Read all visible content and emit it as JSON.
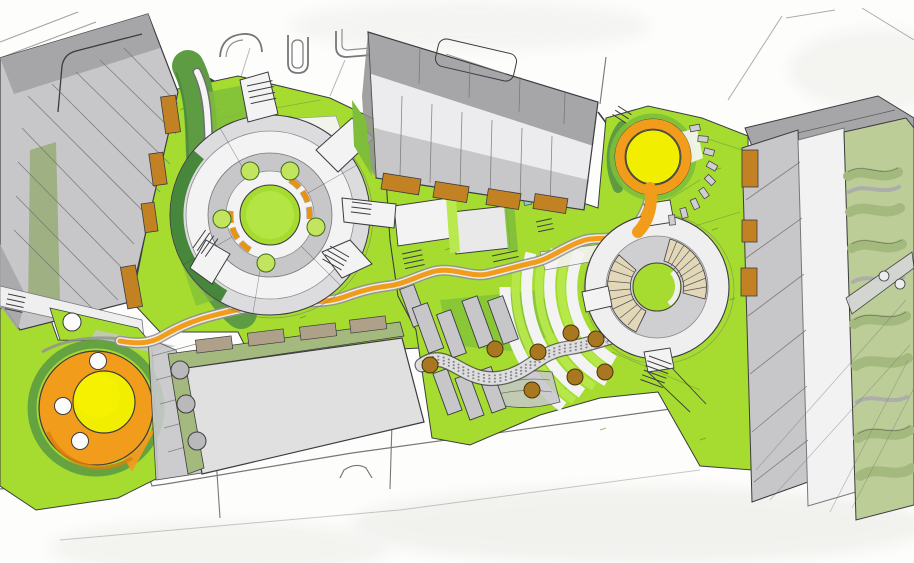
{
  "meta": {
    "kind": "hand-drawn landscape architecture masterplan sketch",
    "canvas_width": 914,
    "canvas_height": 563,
    "visible_text": "none"
  },
  "palette": {
    "paper": "#FDFDFB",
    "paper_wash": "#EDEDEA",
    "lawn": "#A5DC2F",
    "lawn_bright": "#B9E94E",
    "lawn_mid": "#7FBE3A",
    "green_dark": "#5E9C44",
    "green_deep": "#47873B",
    "sage": "#9FB183",
    "sage_band": "#A4B97E",
    "sage_light": "#BCCD97",
    "orange": "#F29C1C",
    "orange_dark": "#D97F0A",
    "yellow": "#F2EE00",
    "planter_orange": "#C28223",
    "planter_tan": "#AFA089",
    "tree_brown": "#A9771F",
    "tree_light": "#C2E45F",
    "building_light": "#E0E0E1",
    "building_mid": "#C7C7C9",
    "building_dark": "#A6A6A8",
    "building_shadow": "#909092",
    "path_gray": "#CFCFD1",
    "path_white": "#F3F3F4",
    "steps_tan": "#E2D8B8",
    "teal": "#9BC7C4",
    "ink": "#3C3C40",
    "pencil": "#77777B"
  },
  "routes": {
    "orange_main": "M 652,186 C 648,208 642,222 628,232 C 614,242 600,236 585,240 C 565,246 552,258 536,262 C 518,266 505,270 488,274 C 470,278 452,266 432,272 C 415,277 404,284 388,286 C 370,288 358,292 344,297 C 322,305 300,300 278,303 C 255,306 238,309 215,315 C 195,320 180,326 163,336 C 150,344 136,344 120,341",
    "pebble": "M 422,365 C 448,346 462,384 500,378 C 530,373 538,352 568,348 C 588,345 600,340 612,337",
    "white_walk": "M 197,72 C 213,104 206,150 211,186 C 215,210 208,232 213,256 C 215,272 219,288 228,300",
    "dark_swath": "M 188,66 C 206,102 199,146 204,184 C 208,214 201,242 210,268 C 217,288 228,302 241,313"
  },
  "scene": {
    "buildings": [
      {
        "id": "northwest-building",
        "style": "grey sketched block, diagonal hatching, sage strip, orange planters on east face"
      },
      {
        "id": "north-building",
        "style": "grey block with light roof band, vertical hatching, orange planters along south face"
      },
      {
        "id": "south-building",
        "style": "flat light-grey roof, sage border with tan planters and grey tree circles"
      },
      {
        "id": "east-building",
        "style": "grey hatched block, white roof strip, orange planters on west face"
      }
    ],
    "features": [
      {
        "id": "central-circular-plaza",
        "rings": "concentric paving",
        "lawn_centre": true,
        "tree_circles": 5,
        "orange_bench_arcs": 2,
        "radial_arms": 5
      },
      {
        "id": "east-circular-plaza",
        "amphitheatre_step_fans": 2,
        "lawn_centre": true
      },
      {
        "id": "northeast-yellow-circle",
        "ring": "orange spiral path"
      },
      {
        "id": "southwest-yellow-circle",
        "ring": "orange disc",
        "white_tree_circles": 3
      },
      {
        "id": "orange-promenade",
        "desc": "winding orange path linking both yellow focal circles"
      },
      {
        "id": "pebble-path",
        "desc": "dotted serpentine gravel walk through courtyard"
      },
      {
        "id": "courtyard",
        "grey_planting_beds": 8,
        "brown_tree_circles": 8,
        "striped_lawn_arcs": 4
      },
      {
        "id": "stepping-stones",
        "count": 9
      },
      {
        "id": "wavy-terrace-garden",
        "bands": 7
      },
      {
        "id": "stairs",
        "flights": 10
      }
    ]
  }
}
